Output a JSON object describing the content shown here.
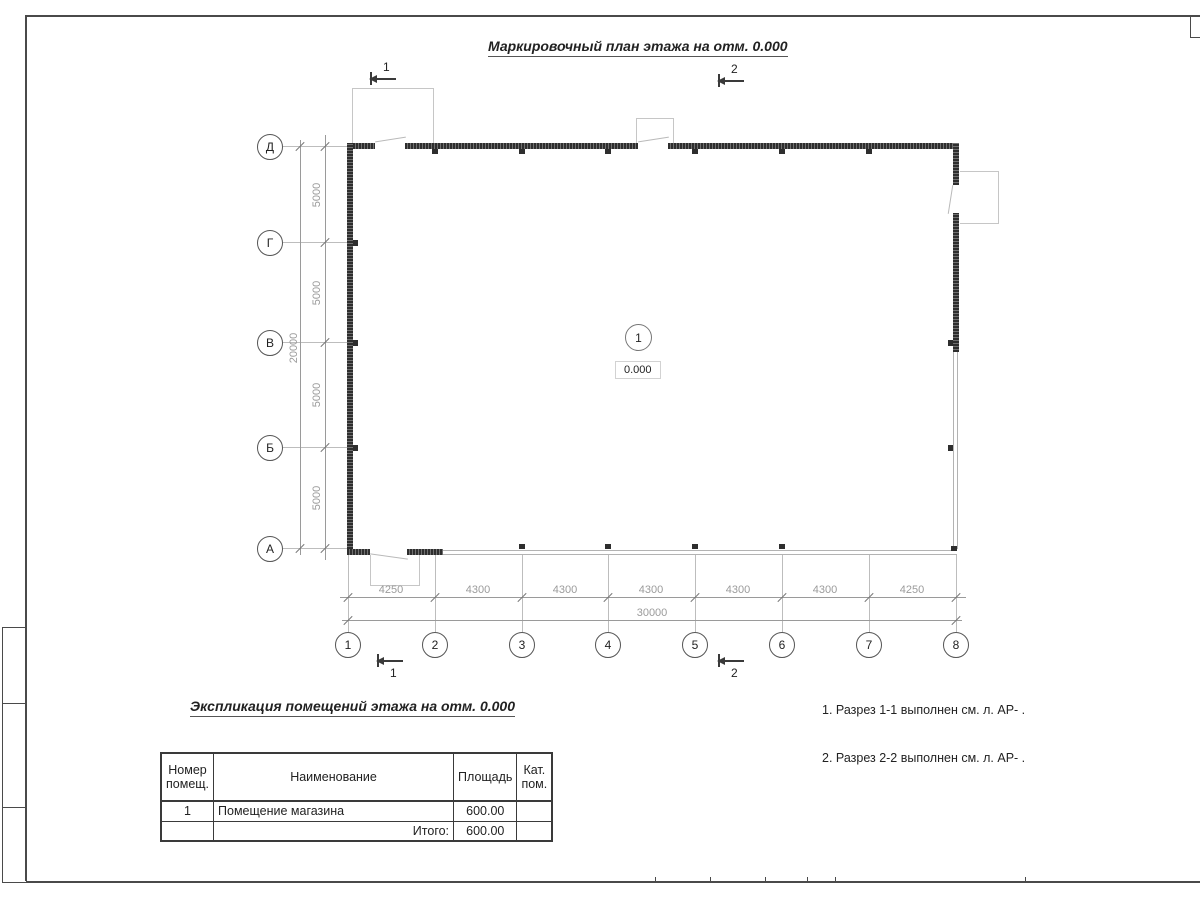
{
  "sheet": {
    "plan_title": "Маркировочный план этажа на отм. 0.000",
    "table_title": "Экспликация помещений этажа на отм. 0.000",
    "notes_line1": "1. Разрез 1-1 выполнен см. л. АР- .",
    "notes_line2": "2. Разрез 2-2 выполнен см. л. АР- ."
  },
  "plan": {
    "room_tag": "1",
    "room_elevation": "0.000",
    "row_axes": [
      "Д",
      "Г",
      "В",
      "Б",
      "А"
    ],
    "col_axes": [
      "1",
      "2",
      "3",
      "4",
      "5",
      "6",
      "7",
      "8"
    ],
    "section_1": "1",
    "section_2": "2",
    "dims": {
      "bottom_segments": [
        "4250",
        "4300",
        "4300",
        "4300",
        "4300",
        "4300",
        "4250"
      ],
      "bottom_total": "30000",
      "left_segments": [
        "5000",
        "5000",
        "5000",
        "5000"
      ],
      "left_total": "20000"
    }
  },
  "table": {
    "header_number": "Номер помещ.",
    "header_name": "Наименование",
    "header_area": "Площадь",
    "header_cat": "Кат. пом.",
    "row1_number": "1",
    "row1_name": "Помещение магазина",
    "row1_area": "600.00",
    "row1_cat": "",
    "total_label": "Итого:",
    "total_area": "600.00",
    "total_cat": ""
  },
  "colors": {
    "wall_dark": "#2e2e2e",
    "wall_light": "#b3b3b3",
    "dim_gray": "#9b9b9b",
    "line_dark": "#3a3a3a"
  }
}
